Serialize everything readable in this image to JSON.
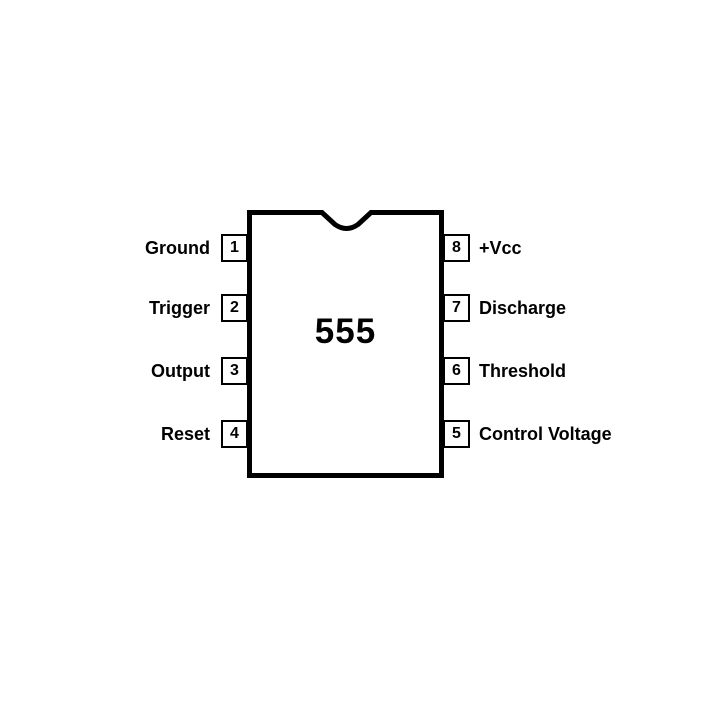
{
  "diagram": {
    "chip_label": "555",
    "package": "8-pin DIP pinout",
    "left_pins": [
      {
        "number": "1",
        "label": "Ground"
      },
      {
        "number": "2",
        "label": "Trigger"
      },
      {
        "number": "3",
        "label": "Output"
      },
      {
        "number": "4",
        "label": "Reset"
      }
    ],
    "right_pins": [
      {
        "number": "8",
        "label": "+Vcc"
      },
      {
        "number": "7",
        "label": "Discharge"
      },
      {
        "number": "6",
        "label": "Threshold"
      },
      {
        "number": "5",
        "label": "Control Voltage"
      }
    ],
    "colors": {
      "line": "#000000",
      "text": "#000000",
      "background": "#ffffff"
    }
  }
}
